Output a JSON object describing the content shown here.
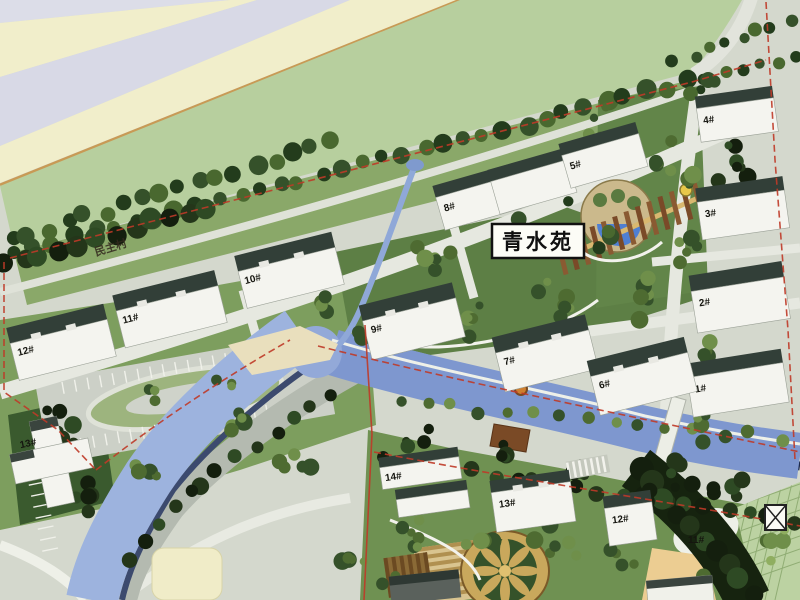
{
  "plan": {
    "project_label": "青水苑",
    "district_label": "民主村",
    "buildings": [
      {
        "label": "12#"
      },
      {
        "label": "11#"
      },
      {
        "label": "10#"
      },
      {
        "label": "8#"
      },
      {
        "label": "5#"
      },
      {
        "label": "4#"
      },
      {
        "label": "3#"
      },
      {
        "label": "2#"
      },
      {
        "label": "1#"
      },
      {
        "label": "9#"
      },
      {
        "label": "7#"
      },
      {
        "label": "6#"
      },
      {
        "label": "13#"
      },
      {
        "label": "14#"
      },
      {
        "label": "13#"
      },
      {
        "label": "12#"
      },
      {
        "label": "11#"
      }
    ],
    "colors": {
      "boundary_red": "#bf3a28",
      "river_blue": "#8fa8d8",
      "pond_blue": "#4f7fd2",
      "lawn_green": "#7d9e5e",
      "building_white": "#f4f4ef",
      "highway_cream": "#f1eecb",
      "highway_lavender": "#d8d9e6"
    }
  }
}
